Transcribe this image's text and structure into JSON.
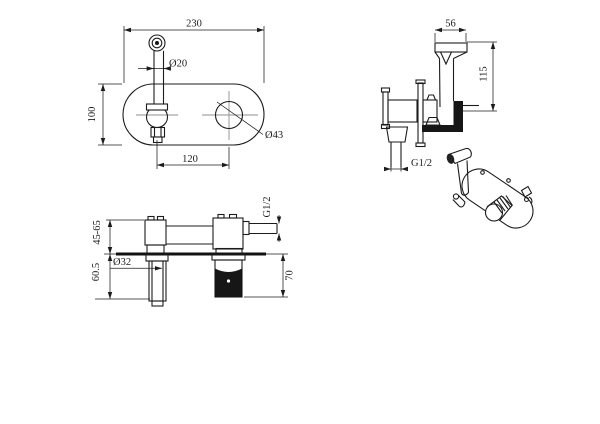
{
  "drawing": {
    "background": "#ffffff",
    "line_color": "#1c1c1c",
    "centerline_color": "#8f8f8f",
    "front_view": {
      "plate_width": "230",
      "plate_height": "100",
      "lever_diameter": "Ø20",
      "outlet_diameter": "Ø43",
      "center_spacing": "120"
    },
    "holder_view": {
      "head_width": "56",
      "overall_height": "115",
      "inlet_thread": "G1/2"
    },
    "section_view": {
      "wall_depth_range": "45-65",
      "handle_projection": "60.5",
      "handle_diameter": "Ø32",
      "outlet_thread": "G1/2",
      "holder_projection": "70"
    }
  }
}
